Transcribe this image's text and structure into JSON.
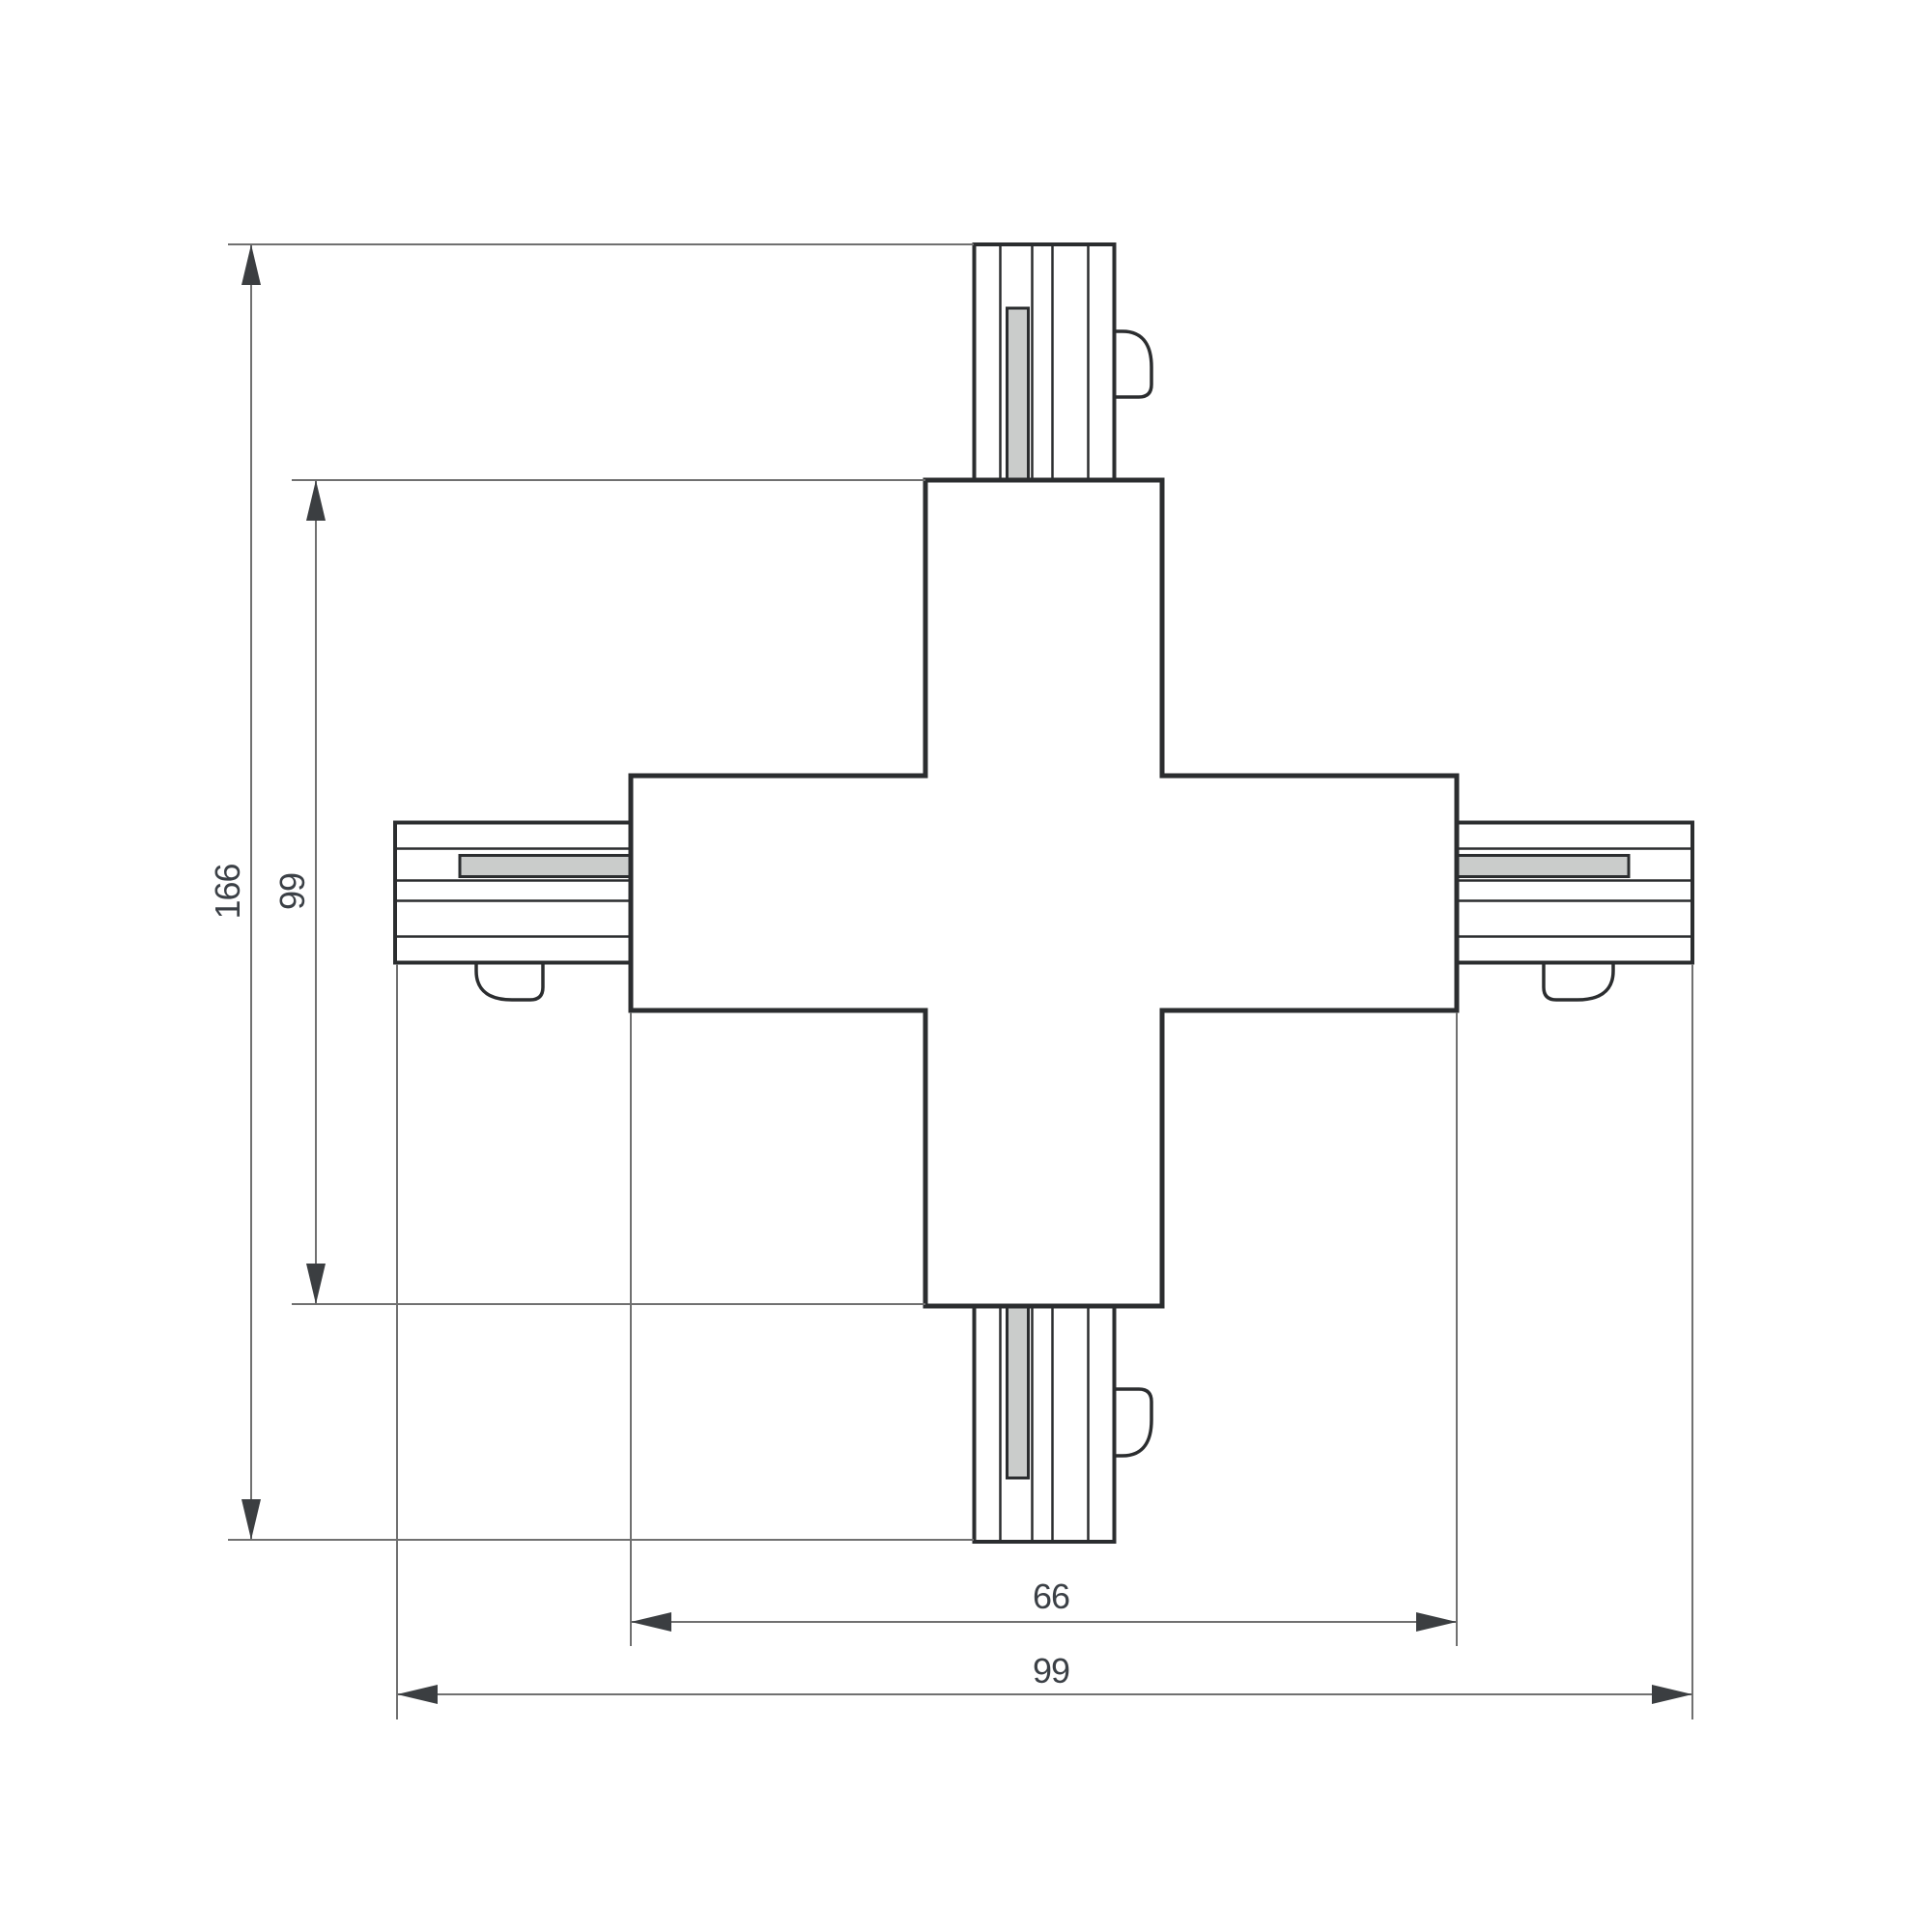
{
  "drawing": {
    "type": "technical-dimension-drawing",
    "subject": "4-way X track connector, top view",
    "dims": {
      "overall_length": "166",
      "body_length": "99",
      "body_width": "66",
      "overall_width": "99"
    },
    "colors": {
      "background": "#ffffff",
      "outline": "#2b2d2f",
      "dimension_line": "#707070",
      "arrow": "#3b3e41",
      "label_text": "#3b4046",
      "contact_insert_fill": "#cacccb"
    }
  }
}
